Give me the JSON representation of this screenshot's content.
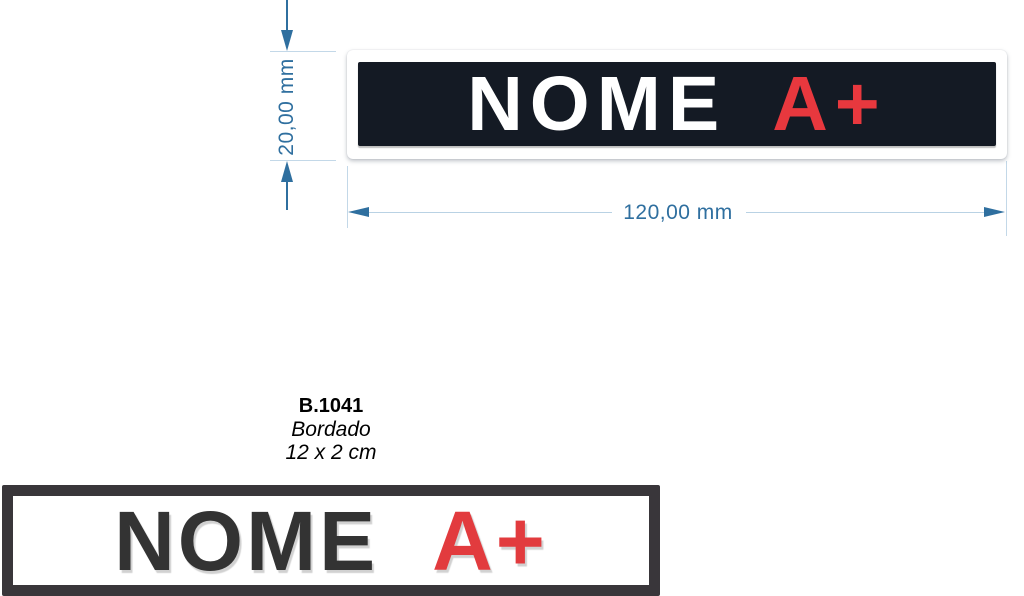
{
  "drawing": {
    "dim_height": {
      "label": "20,00 mm"
    },
    "dim_width": {
      "label": "120,00 mm"
    },
    "colors": {
      "dimension": "#2f6f9f",
      "extension": "#c3d8e8",
      "dim_line": "#b9d2e4"
    }
  },
  "patch_top": {
    "name": "NOME",
    "blood_type": "A+",
    "colors": {
      "border": "#ffffff",
      "background": "#141a24",
      "name": "#ffffff",
      "blood_type": "#e8383e"
    }
  },
  "product_info": {
    "code": "B.1041",
    "technique": "Bordado",
    "size": "12 x 2 cm"
  },
  "patch_bottom": {
    "name": "NOME",
    "blood_type": "A+",
    "colors": {
      "border": "#39363a",
      "background": "#ffffff",
      "name": "#333333",
      "blood_type": "#e23b3e"
    }
  }
}
